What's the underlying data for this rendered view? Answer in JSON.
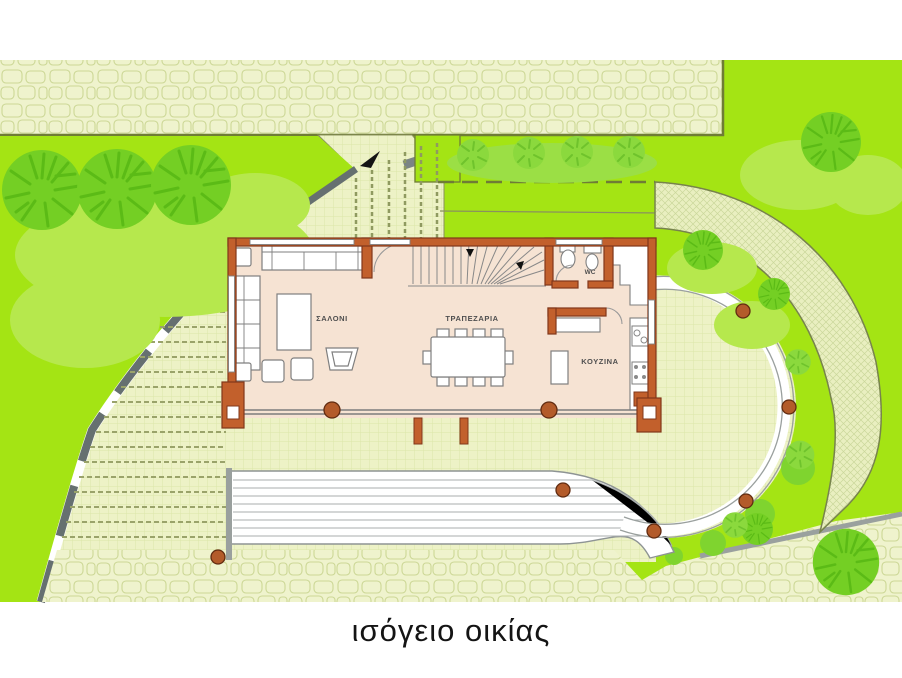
{
  "caption": {
    "text": "ισόγειο οικίας"
  },
  "floor_plan": {
    "rooms": [
      {
        "name": "living-room",
        "label": "ΣΑΛΟΝΙ"
      },
      {
        "name": "dining-room",
        "label": "ΤΡΑΠΕΖΑΡΙΑ"
      },
      {
        "name": "kitchen",
        "label": "ΚΟΥΖΙΝΑ"
      },
      {
        "name": "wc",
        "label": "WC"
      }
    ]
  },
  "colors": {
    "lawn": "#a4e414",
    "tree": "#74cf24",
    "shrub": "#b6e84d",
    "paving": "#edf2c6",
    "stone": "#eff3cd",
    "path_band": "#e9efc0",
    "house_wall": "#c2602c",
    "floor": "#f6e3d3",
    "retaining_wall": "#667070",
    "posts": "#b35b2a"
  }
}
